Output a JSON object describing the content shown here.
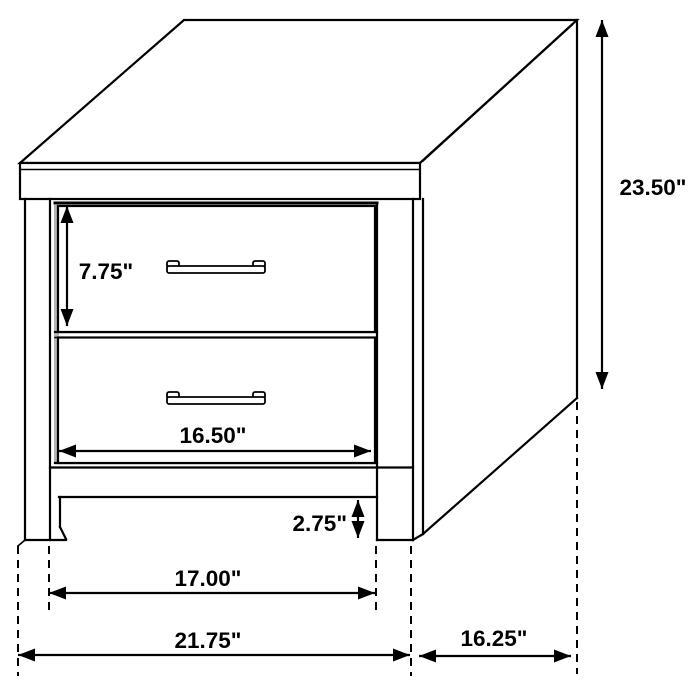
{
  "diagram": {
    "unit": "inches",
    "dimensions": {
      "overall_height": {
        "label": "23.50\"",
        "value": 23.5
      },
      "drawer_height": {
        "label": "7.75\"",
        "value": 7.75
      },
      "drawer_width": {
        "label": "16.50\"",
        "value": 16.5
      },
      "base_clearance": {
        "label": "2.75\"",
        "value": 2.75
      },
      "leg_span": {
        "label": "17.00\"",
        "value": 17.0
      },
      "overall_width": {
        "label": "21.75\"",
        "value": 21.75
      },
      "overall_depth": {
        "label": "16.25\"",
        "value": 16.25
      }
    }
  }
}
